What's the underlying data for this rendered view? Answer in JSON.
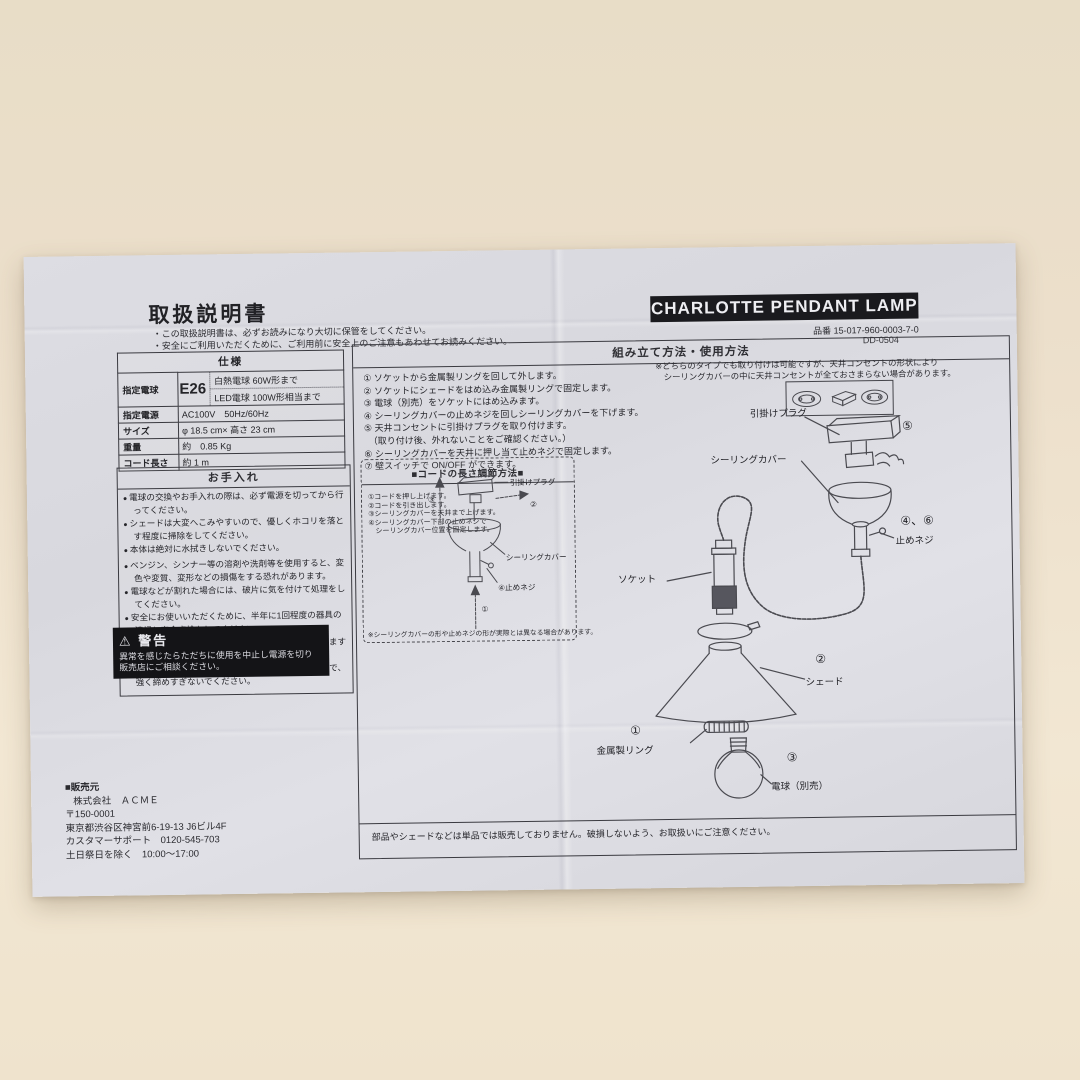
{
  "page": {
    "title": "取扱説明書",
    "note1": "・この取扱説明書は、必ずお読みになり大切に保管をしてください。",
    "note2": "・安全にご利用いただくために、ご利用前に安全上のご注意もあわせてお読みください。"
  },
  "product": {
    "name": "CHARLOTTE PENDANT LAMP",
    "part_label": "品番",
    "part_no": "15-017-960-0003-7-0",
    "doc_no": "DD-0504"
  },
  "specs": {
    "title": "仕様",
    "bulb_label": "指定電球",
    "bulb_type": "E26",
    "bulb_line1": "白熱電球 60W形まで",
    "bulb_line2": "LED電球 100W形相当まで",
    "power_label": "指定電源",
    "power_value": "AC100V　50Hz/60Hz",
    "size_label": "サイズ",
    "size_value": "φ 18.5 cm× 高さ 23 cm",
    "weight_label": "重量",
    "weight_value": "約　0.85 Kg",
    "cord_label": "コード長さ",
    "cord_value": "約 1 m"
  },
  "care": {
    "title": "お手入れ",
    "items": [
      "電球の交換やお手入れの際は、必ず電源を切ってから行ってください。",
      "シェードは大変へこみやすいので、優しくホコリを落とす程度に掃除をしてください。",
      "本体は絶対に水拭きしないでください。",
      "ベンジン、シンナー等の溶剤や洗剤等を使用すると、変色や変質、変形などの損傷をする恐れがあります。",
      "電球などが割れた場合には、破片に気を付けて処理をしてください。",
      "安全にお使いいただくために、半年に1回程度の器具の清掃と安全点検をしてください。",
      "コンセント部分のホコリも発火や火災の原因になりますので、こまめに清掃をしてください。",
      "シーリングカバー固定用の止めネジは潰れやすいので、強く締めすぎないでください。"
    ]
  },
  "warning": {
    "icon": "⚠",
    "title": "警告",
    "line1": "異常を感じたらただちに使用を中止し電源を切り",
    "line2": "販売店にご相談ください。"
  },
  "assembly": {
    "title": "組み立て方法・使用方法",
    "steps": [
      "① ソケットから金属製リングを回して外します。",
      "② ソケットにシェードをはめ込み金属製リングで固定します。",
      "③ 電球（別売）をソケットにはめ込みます。",
      "④ シーリングカバーの止めネジを回しシーリングカバーを下げます。",
      "⑤ 天井コンセントに引掛けプラグを取り付けます。",
      "　（取り付け後、外れないことをご確認ください。）",
      "⑥ シーリングカバーを天井に押し当て止めネジで固定します。",
      "⑦ 壁スイッチで ON/OFF ができます。"
    ],
    "type_note1": "※どちらのタイプでも取り付けは可能ですが、天井コンセントの形状により",
    "type_note2": "　シーリングカバーの中に天井コンセントが全ておさまらない場合があります。",
    "bottom_note": "部品やシェードなどは単品では販売しておりません。破損しないよう、お取扱いにご注意ください。"
  },
  "diagram": {
    "plug_label": "引掛けプラグ",
    "plug_marker": "⑤",
    "cover_label": "シーリングカバー",
    "screw_marker": "④、⑥",
    "screw_label": "止めネジ",
    "socket_label": "ソケット",
    "shade_marker": "②",
    "shade_label": "シェード",
    "ring_marker": "①",
    "ring_label": "金属製リング",
    "bulb_marker": "③",
    "bulb_label": "電球（別売）"
  },
  "cord_box": {
    "title": "■コードの長さ調節方法■",
    "steps": [
      "①コードを押し上げます。",
      "②コードを引き出します。",
      "③シーリングカバーを天井まで上げます。",
      "④シーリングカバー下部の止めネジで",
      "　シーリングカバー位置を固定します。"
    ],
    "plug_label": "引掛けプラグ",
    "cover_label": "シーリングカバー",
    "screw_marker": "④",
    "screw_label": "止めネジ",
    "marker_up": "①",
    "marker_pull": "②",
    "marker_raise": "③",
    "note": "※シーリングカバーの形や止めネジの形が実際とは異なる場合があります。"
  },
  "seller": {
    "heading": "■販売元",
    "company": "株式会社　ＡＣＭＥ",
    "zip": "〒150-0001",
    "address": "東京都渋谷区神宮前6-19-13 J6ビル4F",
    "support": "カスタマーサポート　0120-545-703",
    "hours": "土日祭日を除く　10:00〜17:00"
  }
}
